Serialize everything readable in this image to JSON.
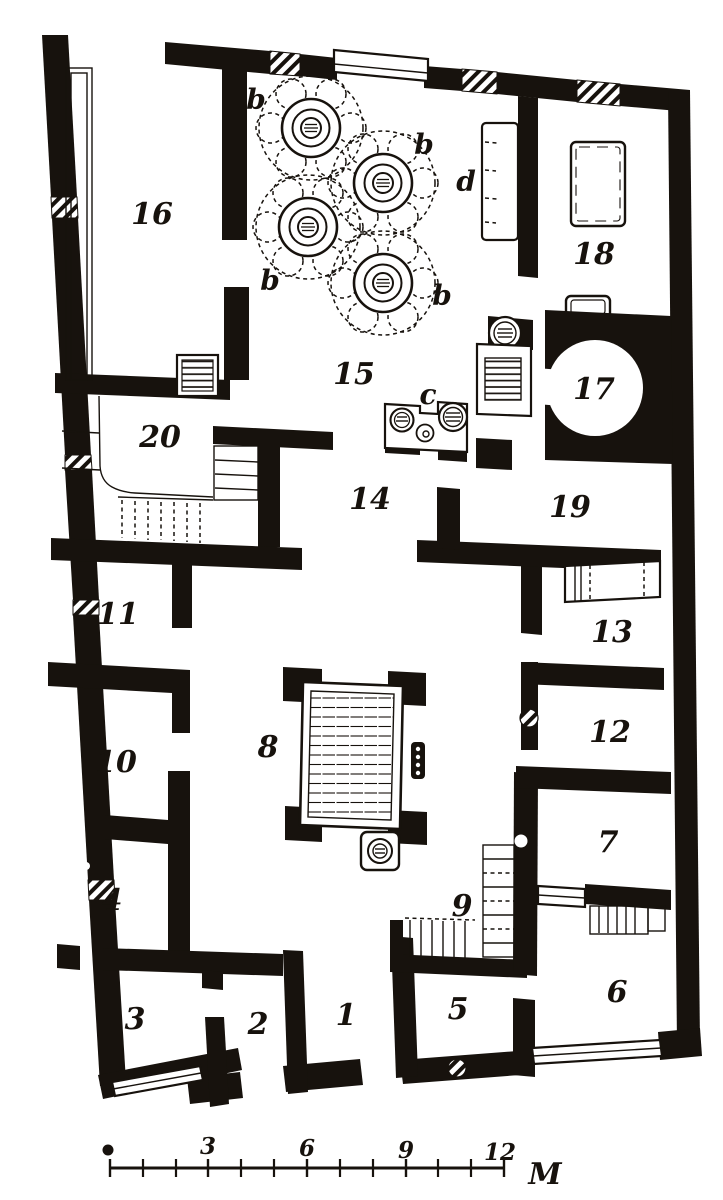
{
  "figure": {
    "kind": "engraved house floor plan",
    "ink_color": "#17120d",
    "paper_color": "#ffffff",
    "room_labels": {
      "r1": "1",
      "r2": "2",
      "r3": "3",
      "r4": "4",
      "r5": "5",
      "r6": "6",
      "r7": "7",
      "r8": "8",
      "r9": "9",
      "r10": "10",
      "r11": "11",
      "r12": "12",
      "r13": "13",
      "r14": "14",
      "r15": "15",
      "r16": "16",
      "r17": "17",
      "r18": "18",
      "r19": "19",
      "r20": "20"
    },
    "feature_labels": {
      "tree_b_1": "b",
      "tree_b_2": "b",
      "tree_b_3": "b",
      "tree_b_4": "b",
      "hearth_c": "c",
      "recess_d": "d"
    },
    "scale_bar": {
      "tick_labels": [
        "3",
        "6",
        "9",
        "12"
      ],
      "unit_label": "M"
    }
  }
}
